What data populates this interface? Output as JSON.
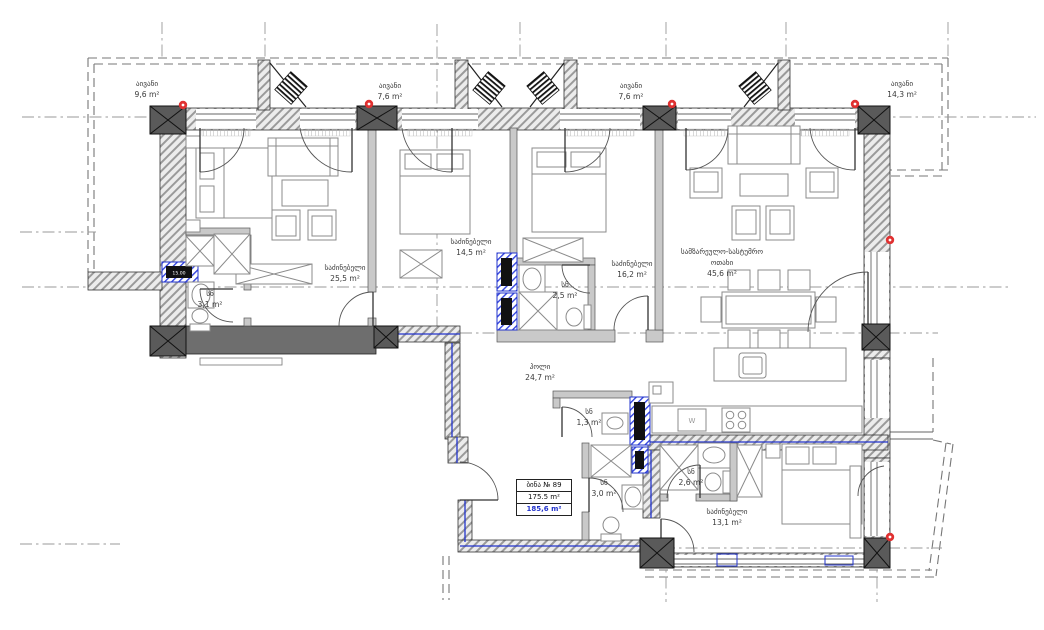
{
  "rooms": [
    {
      "id": "balcony-top-left",
      "name": "აივანი",
      "area": "9,6 m²"
    },
    {
      "id": "balcony-mid-left",
      "name": "აივანი",
      "area": "7,6 m²"
    },
    {
      "id": "balcony-mid-right",
      "name": "აივანი",
      "area": "7,6 m²"
    },
    {
      "id": "balcony-top-right",
      "name": "აივანი",
      "area": "14,3 m²"
    },
    {
      "id": "bedroom-left",
      "name": "საძინებელი",
      "area": "25,5 m²"
    },
    {
      "id": "bathroom-left",
      "name": "სნ",
      "area": "3,1 m²"
    },
    {
      "id": "bedroom-mid-left",
      "name": "საძინებელი",
      "area": "14,5 m²"
    },
    {
      "id": "bathroom-mid",
      "name": "სნ",
      "area": "2,5 m²"
    },
    {
      "id": "bedroom-mid-right",
      "name": "საძინებელი",
      "area": "16,2 m²"
    },
    {
      "id": "kitchen-living",
      "name": "სამზარეულო-სასტუმრო",
      "name2": "ოთახი",
      "area": "45,6 m²"
    },
    {
      "id": "hall",
      "name": "ჰოლი",
      "area": "24,7 m²"
    },
    {
      "id": "wc-small",
      "name": "სნ",
      "area": "1,3 m²"
    },
    {
      "id": "bathroom-bottom",
      "name": "სნ",
      "area": "3,0 m²"
    },
    {
      "id": "bathroom-bottom-right",
      "name": "სნ",
      "area": "2,6 m²"
    },
    {
      "id": "bedroom-bottom",
      "name": "საძინებელი",
      "area": "13,1 m²"
    }
  ],
  "apartment": {
    "number": "ბინა № 89",
    "area_living": "175.5 m²",
    "area_total": "185,6 m²"
  },
  "labels": {
    "washer": "W",
    "shaft_size": "15.00"
  },
  "colors": {
    "accent_blue": "#2233cc",
    "marker_red": "#e03131",
    "wall_dark": "#6e6e6e"
  }
}
